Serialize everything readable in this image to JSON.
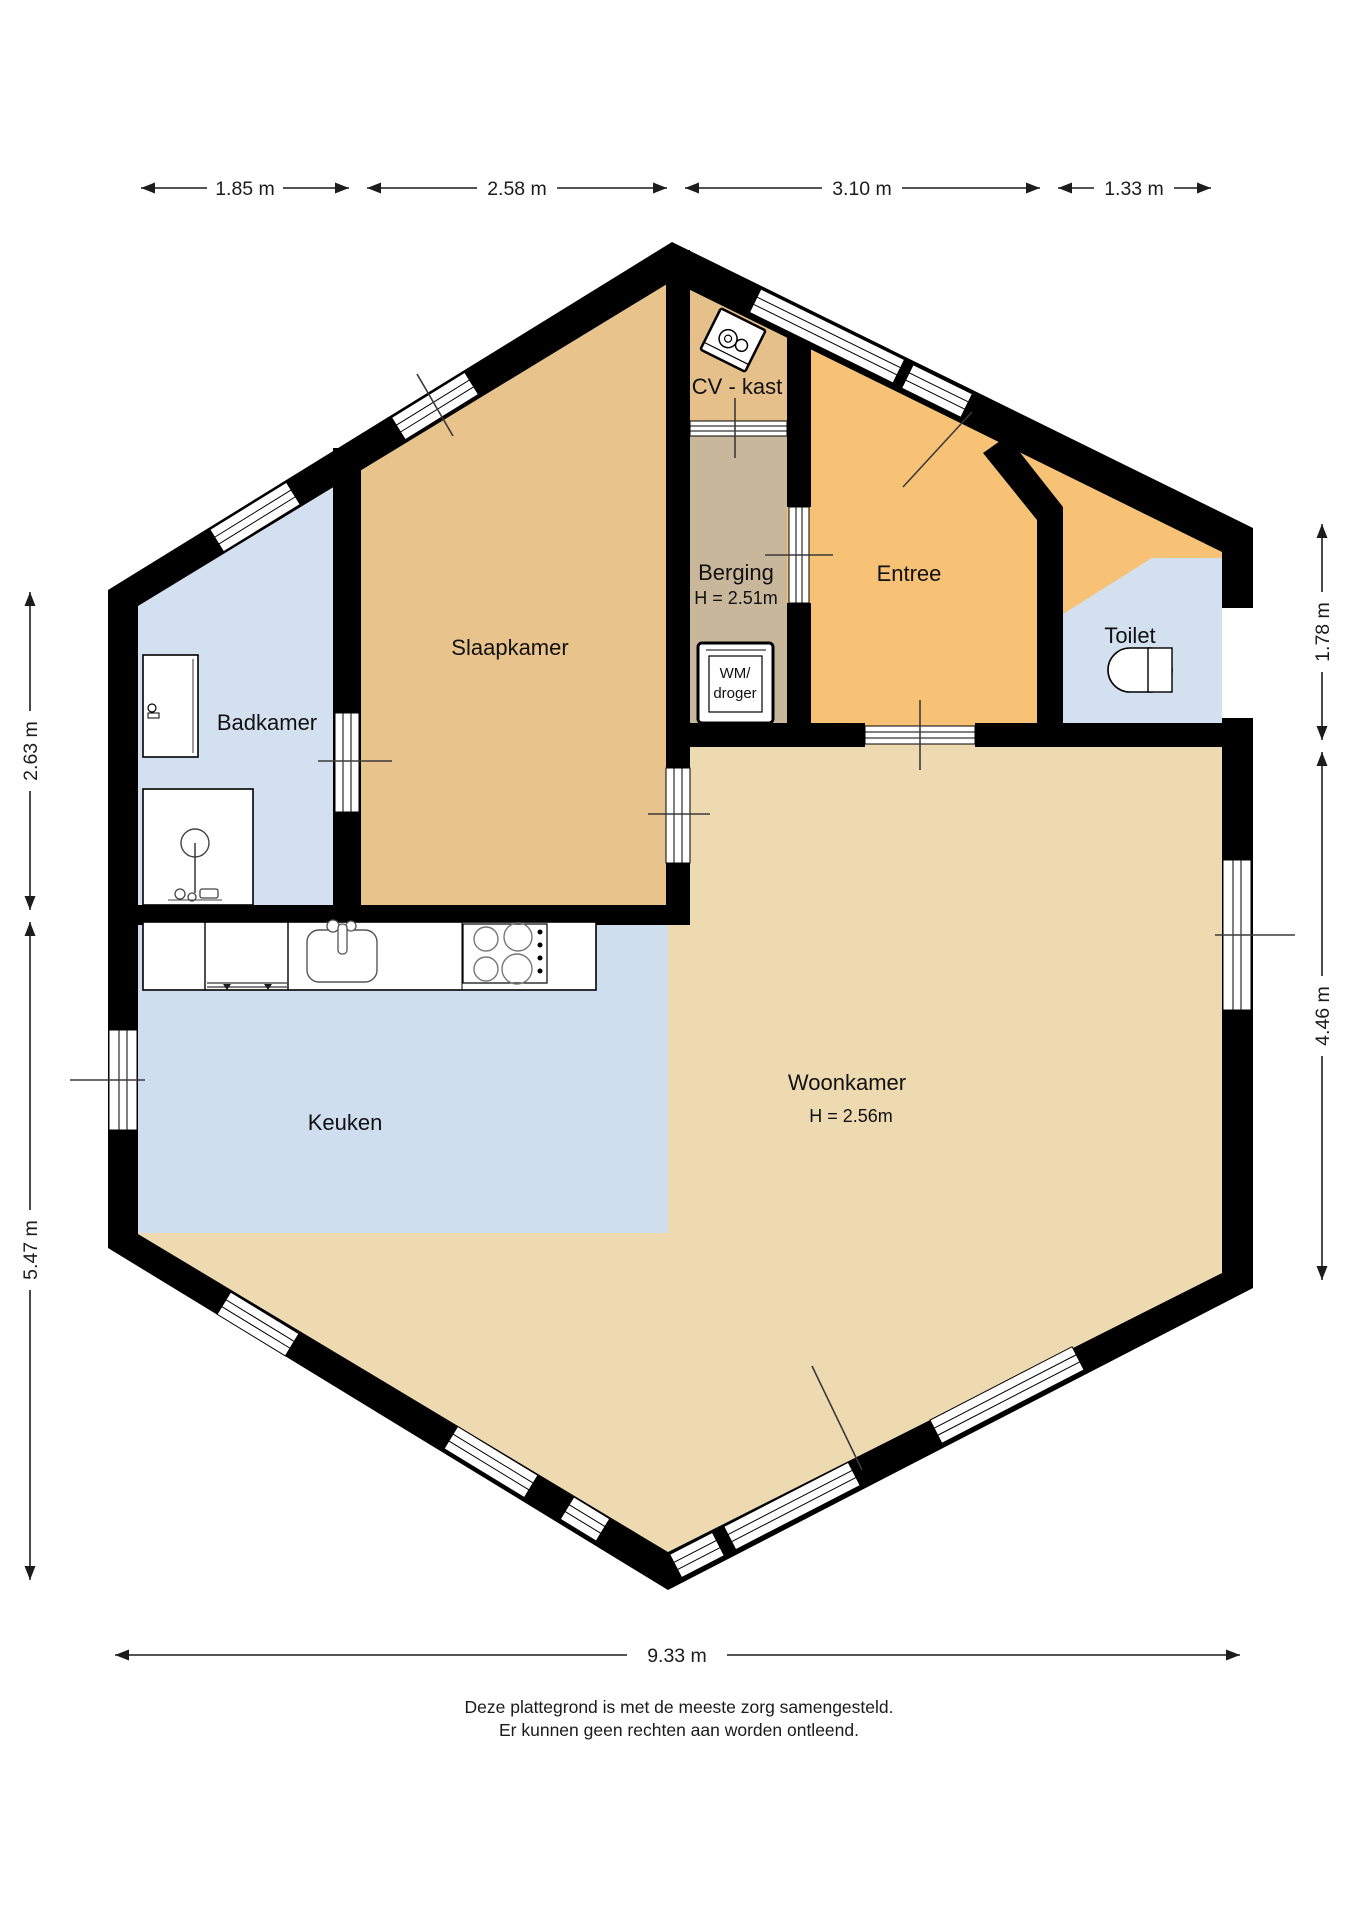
{
  "plan": {
    "rooms": {
      "slaapkamer": {
        "label": "Slaapkamer"
      },
      "badkamer": {
        "label": "Badkamer"
      },
      "keuken": {
        "label": "Keuken"
      },
      "woonkamer": {
        "label": "Woonkamer",
        "height_note": "H = 2.56m"
      },
      "entree": {
        "label": "Entree"
      },
      "toilet": {
        "label": "Toilet"
      },
      "berging": {
        "label": "Berging",
        "height_note": "H = 2.51m"
      },
      "cv_kast": {
        "label": "CV - kast"
      },
      "wasmachine": {
        "line1": "WM/",
        "line2": "droger"
      }
    },
    "dimensions": {
      "top": [
        "1.85 m",
        "2.58 m",
        "3.10 m",
        "1.33 m"
      ],
      "left": [
        "2.63 m",
        "5.47 m"
      ],
      "right": [
        "1.78 m",
        "4.46 m"
      ],
      "bottom": [
        "9.33 m"
      ]
    },
    "footer": {
      "line1": "Deze plattegrond is met de meeste zorg samengesteld.",
      "line2": "Er kunnen geen rechten aan worden ontleend."
    },
    "colors": {
      "wall": "#000000",
      "slaapkamer": "#e8c38c",
      "cv_kast": "#e5c08b",
      "berging": "#c9b79c",
      "entree": "#f7c276",
      "woonkamer": "#eedab1",
      "natte_ruimte": "#d2e0ef",
      "keuken": "#cfdeee"
    }
  }
}
